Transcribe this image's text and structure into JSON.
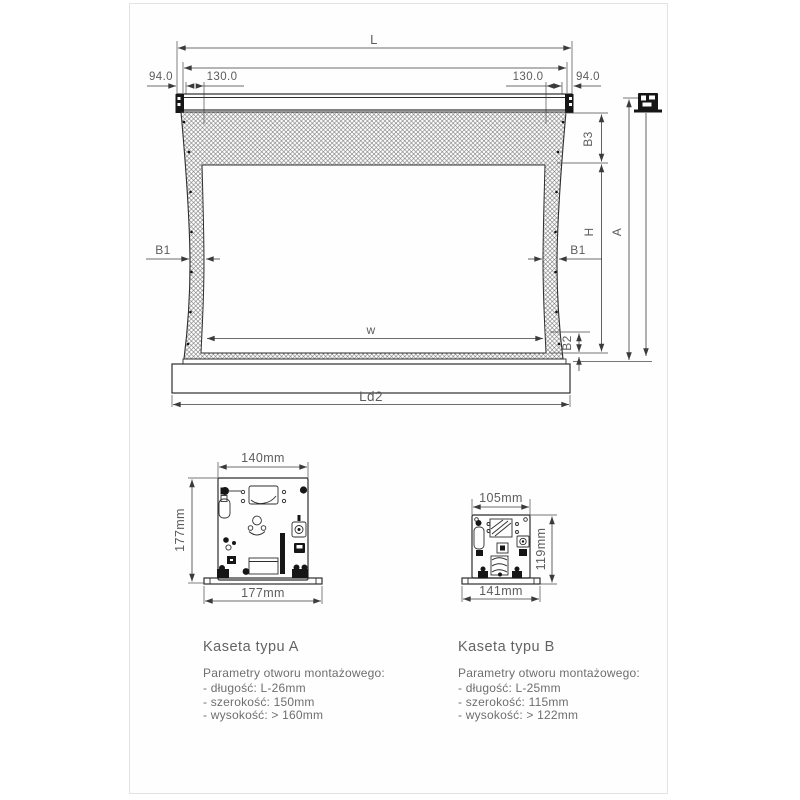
{
  "screen_diagram": {
    "labels": {
      "total_length": "L",
      "end_offset": "94.0",
      "bracket_offset": "130.0",
      "top_border": "B3",
      "viewing_height": "H",
      "total_height": "A",
      "side_border": "B1",
      "bottom_border": "B2",
      "viewing_width": "w",
      "bottom_bar_length": "Ld2"
    }
  },
  "cassette_a": {
    "title": "Kaseta typu A",
    "top_width": "140mm",
    "side_height": "177mm",
    "base_width": "177mm",
    "params_heading": "Parametry otworu montażowego:",
    "params": [
      "- długość: L-26mm",
      "- szerokość: 150mm",
      "- wysokość: > 160mm"
    ]
  },
  "cassette_b": {
    "title": "Kaseta typu B",
    "top_width": "105mm",
    "side_height": "119mm",
    "base_width": "141mm",
    "params_heading": "Parametry otworu montażowego:",
    "params": [
      "- długość: L-25mm",
      "- szerokość: 115mm",
      "- wysokość: > 122mm"
    ]
  }
}
